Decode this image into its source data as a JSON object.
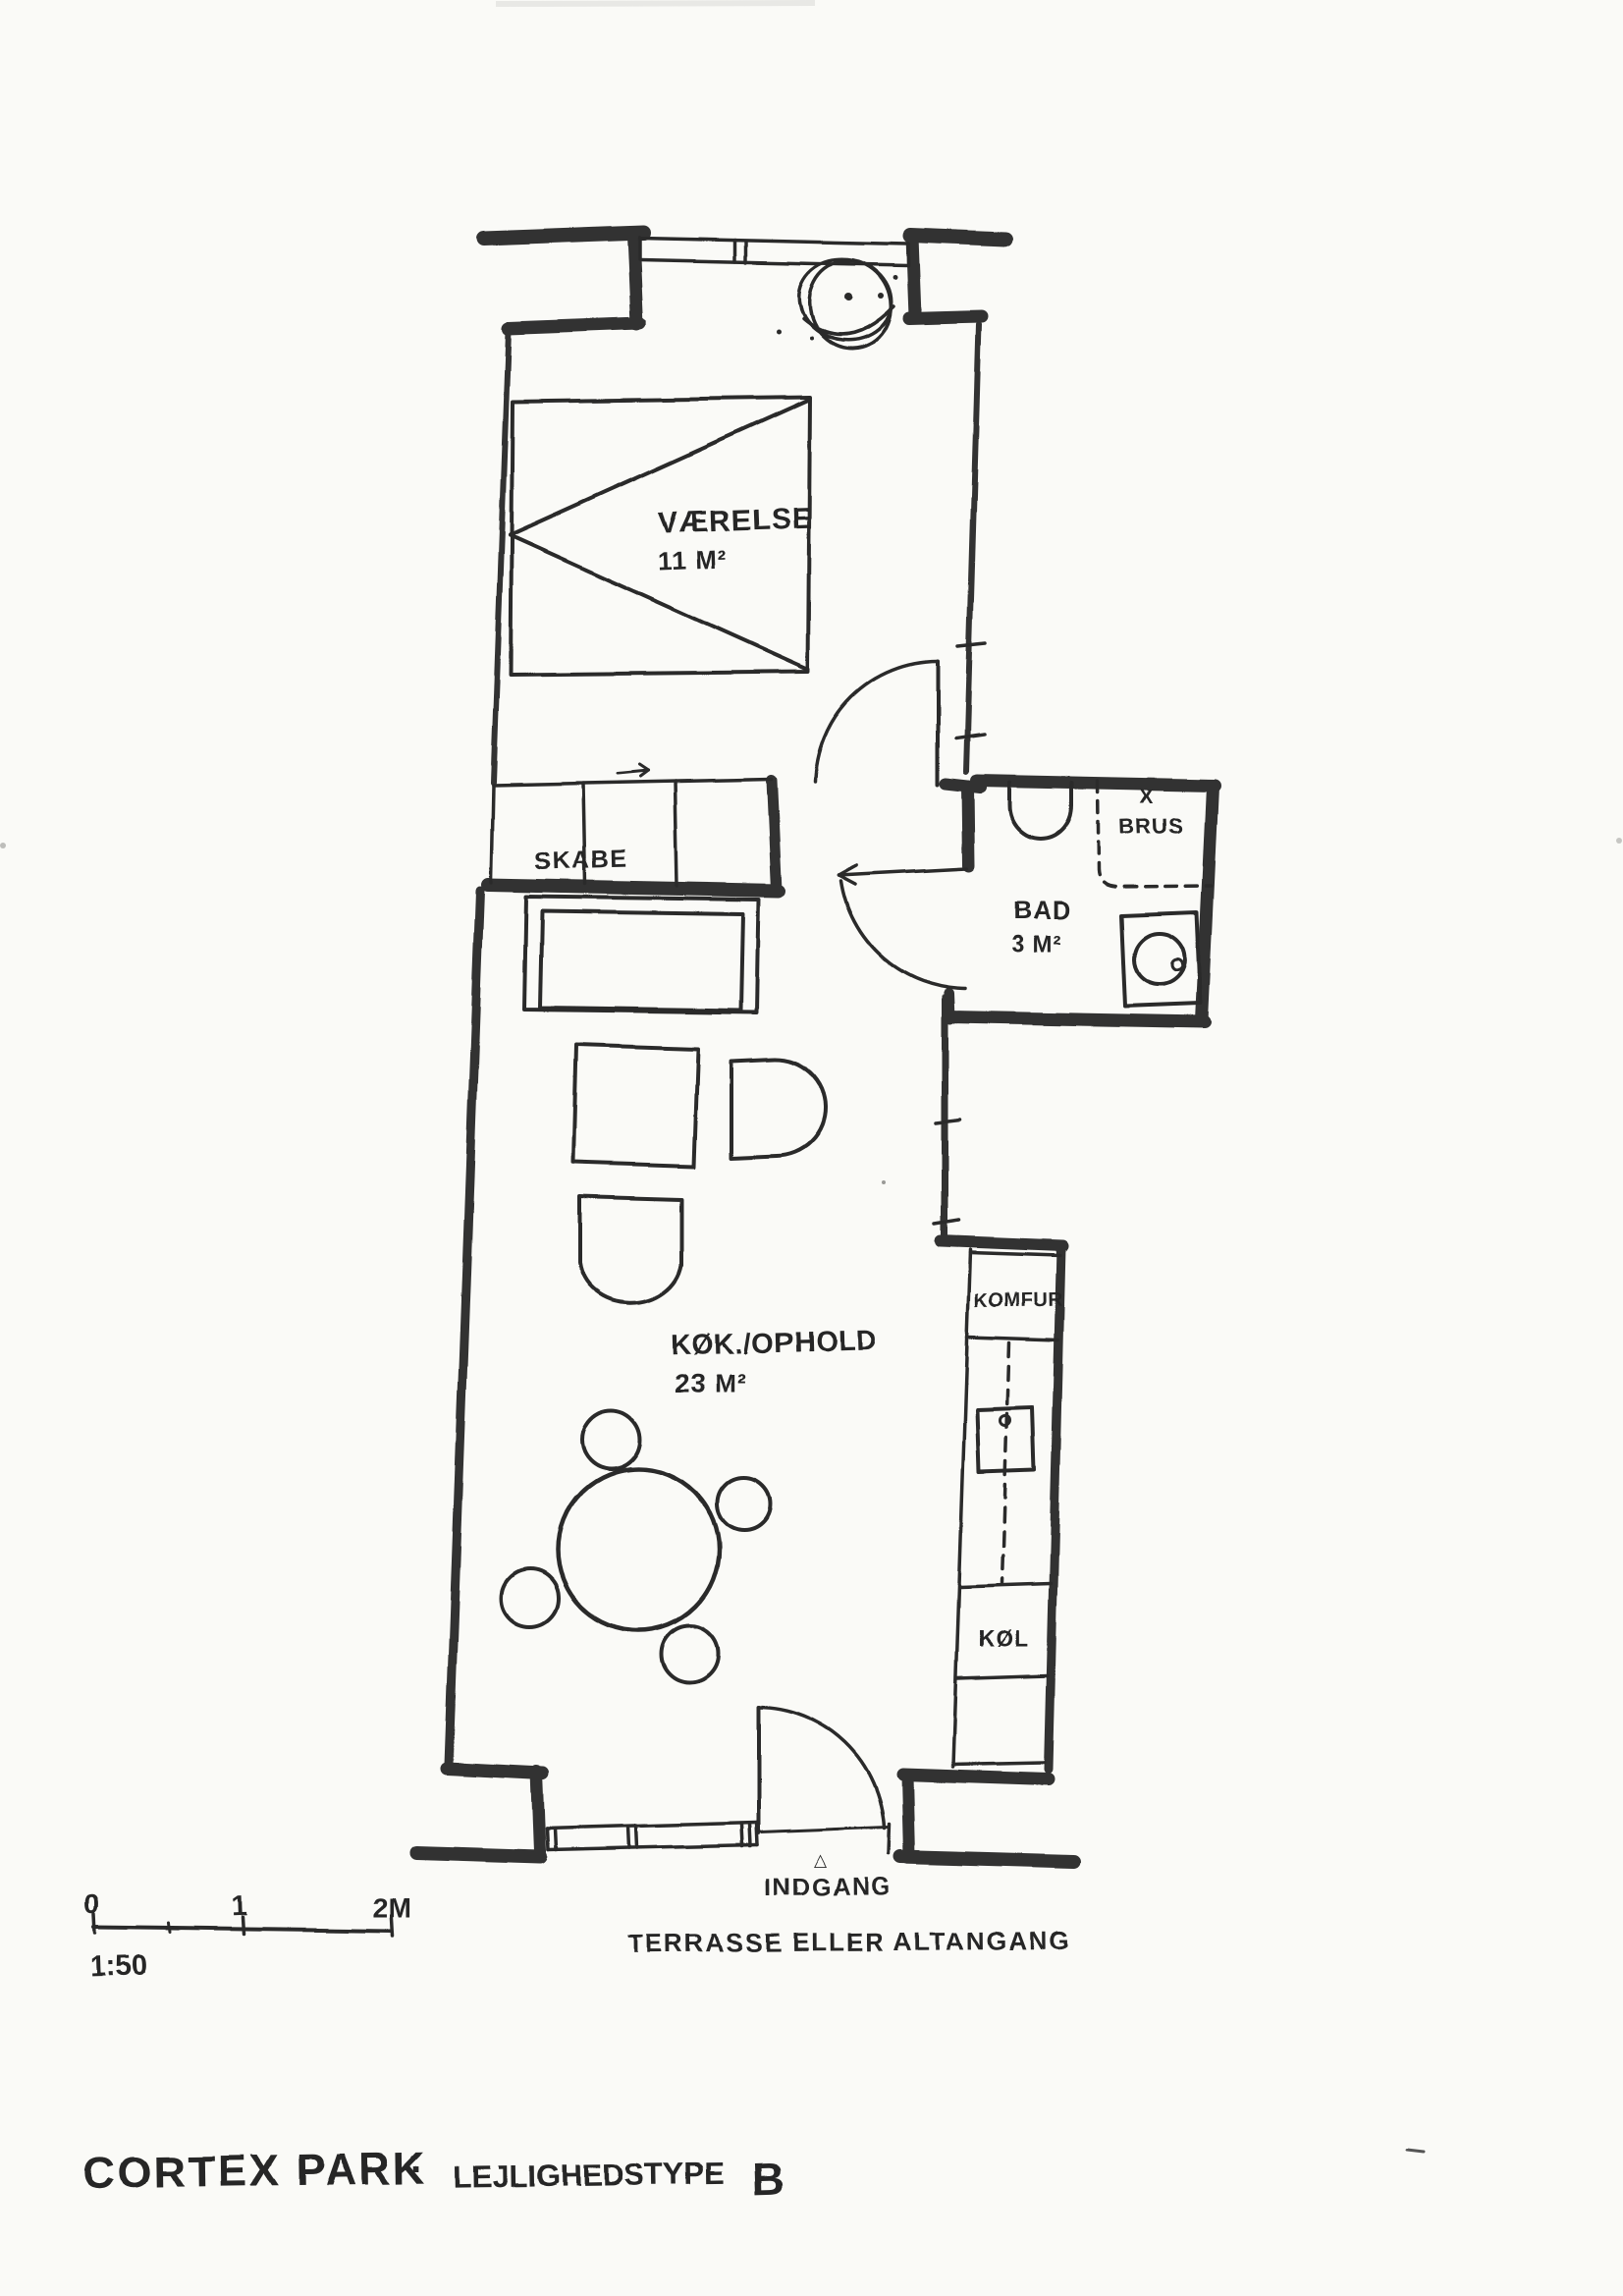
{
  "colors": {
    "paper": "#fafaf7",
    "ink": "#2c2c2c"
  },
  "plan": {
    "bedroom": {
      "name": "VÆRELSE",
      "area": "11 M²"
    },
    "closet": {
      "label": "SKABE"
    },
    "bathroom": {
      "name": "BAD",
      "area": "3 M²",
      "shower_mark": "X",
      "shower_label": "BRUS"
    },
    "kitchen_living": {
      "name": "KØK./OPHOLD",
      "area": "23 M²"
    },
    "appliances": {
      "stove": "KOMFUR",
      "fridge": "KØL"
    },
    "entrance": {
      "marker": "△",
      "label": "INDGANG"
    },
    "outdoor_label": "TERRASSE ELLER ALTANGANG"
  },
  "scale_bar": {
    "tick_start": "0",
    "tick_middle": "1",
    "tick_end": "2M",
    "ratio": "1:50"
  },
  "title_block": {
    "project": "CORTEX PARK",
    "separator": "·",
    "type_label": "LEJLIGHEDSTYPE",
    "type_value": "B"
  }
}
